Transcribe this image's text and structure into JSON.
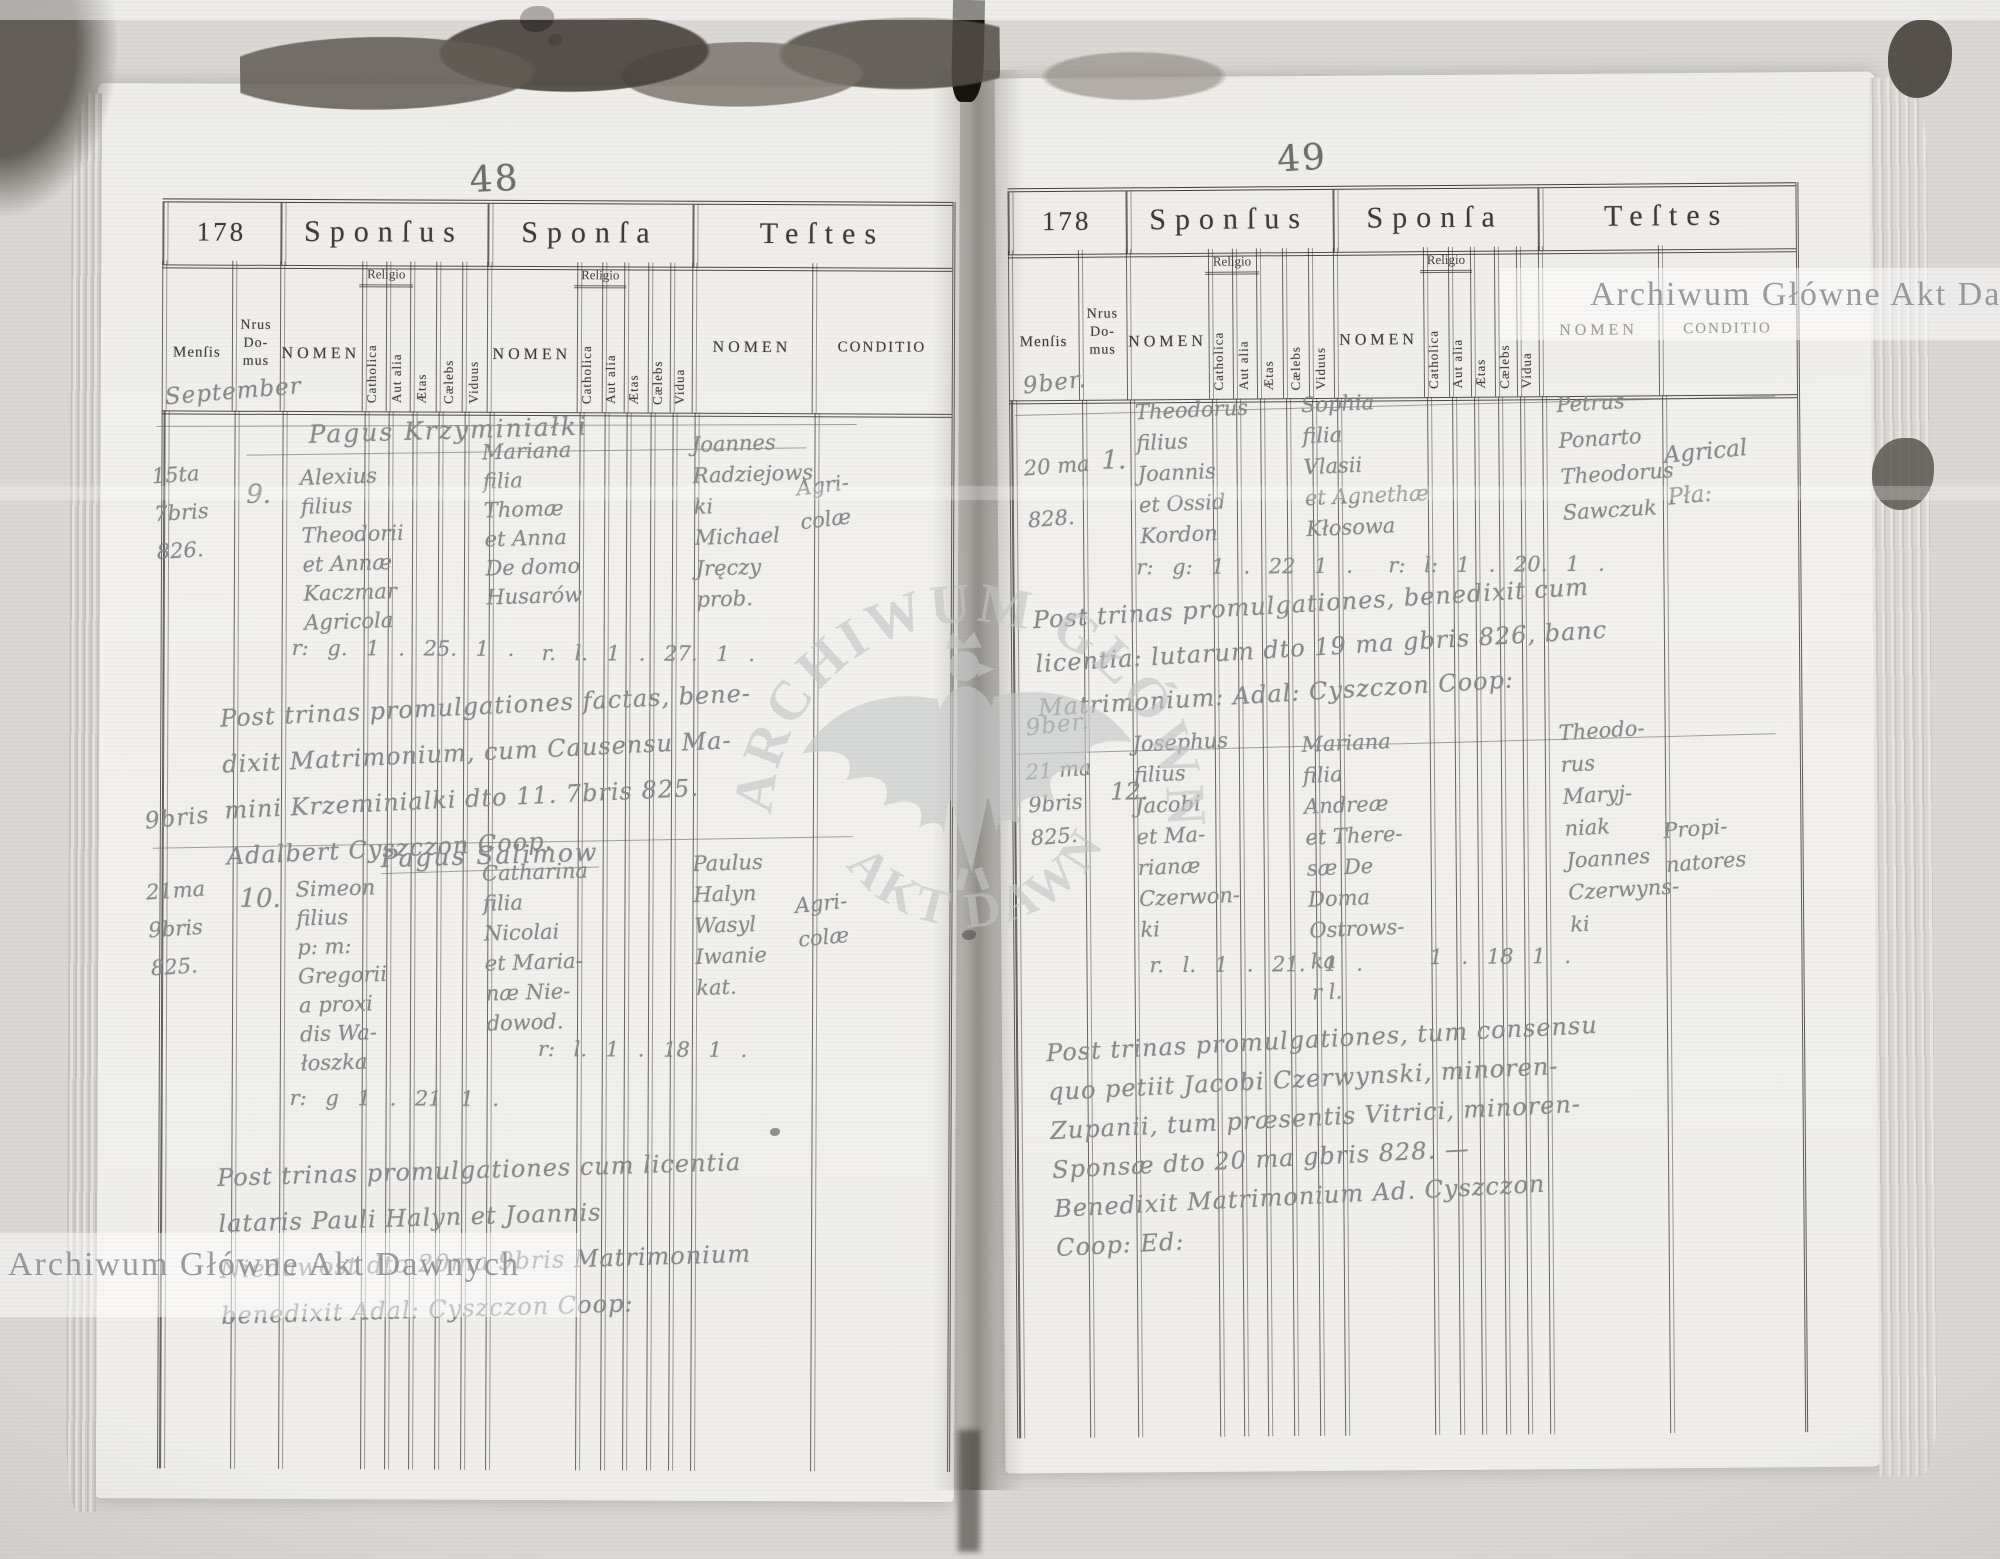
{
  "archive_stamp": "Archiwum Główne Akt Dawnych",
  "watermark": {
    "arc_top": "ARCHIWUM GŁÓWNE",
    "arc_bottom": "AKT DAWNYCH",
    "icon": "polish-eagle-watermark"
  },
  "form": {
    "form_no": "178",
    "sections": {
      "sponsus": "Sponſus",
      "sponsa": "Sponſa",
      "testes": "Teſtes"
    },
    "columns": {
      "mensis": "Menſis",
      "nrus_domus": [
        "Nrus",
        "Do-",
        "mus"
      ],
      "nomen": "NOMEN",
      "religio": "Religio",
      "catholica": "Catholica",
      "aut_alia": "Aut alia",
      "aetas": "Ætas",
      "caelebs": "Cælebs",
      "viduus": "Viduus",
      "vidua": "Vidua",
      "conditio": "CONDITIO"
    }
  },
  "pages": {
    "left": {
      "page_number": "48",
      "month_margin": "September",
      "entries": [
        {
          "date_lines": [
            "15ta",
            "7bris",
            "826."
          ],
          "house": "9.",
          "village": "Pagus Krzyminiałki",
          "groom_lines": [
            "Alexius",
            "filius",
            "Theodorii",
            "et Annæ",
            "Kaczmar",
            "Agricola"
          ],
          "groom_row": "r: g. 1 . 25. 1 .",
          "bride_lines": [
            "Mariana",
            "filia",
            "Thomæ",
            "et Anna",
            "De domo",
            "Husarów"
          ],
          "bride_row": "r. l. 1 . 27. 1 .",
          "witness_lines": [
            "Joannes",
            "Radziejows",
            "ki",
            "Michael",
            "Jręczy",
            "prob."
          ],
          "witness_condition": [
            "Agri-",
            "colæ"
          ],
          "note_lines": [
            "Post trinas promulgationes factas, bene-",
            "dixit Matrimonium, cum Causensu Ma-",
            "mini Krzeminialki dto 11. 7bris 825.",
            "Adalbert Cyszczon Coop."
          ]
        },
        {
          "margin": "9bris",
          "date_lines": [
            "21ma",
            "9bris",
            "825."
          ],
          "house": "10.",
          "village": "Pagus Salimow",
          "groom_lines": [
            "Simeon",
            "filius",
            "p: m:",
            "Gregorii",
            "a proxi",
            "dis Wa-",
            "łoszka"
          ],
          "groom_row": "r: g 1 . 21 1 .",
          "bride_lines": [
            "Catharina",
            "filia",
            "Nicolai",
            "et Maria-",
            "næ Nie-",
            "dowod."
          ],
          "bride_row": "r: l. 1 . 18 1 .",
          "witness_lines": [
            "Paulus",
            "Halyn",
            "Wasyl",
            "Iwanie",
            "kat."
          ],
          "witness_condition": [
            "Agri-",
            "colæ"
          ],
          "note_lines": [
            "Post trinas promulgationes cum licentia",
            "lataris Pauli Halyn et Joannis",
            "Niedawost dto 20ma 9bris Matrimonium",
            "benedixit Adal: Cyszczon Coop:"
          ]
        }
      ]
    },
    "right": {
      "page_number": "49",
      "entries": [
        {
          "margin": "9ber.",
          "date_lines": [
            "20 ma",
            "828."
          ],
          "house": "1.",
          "groom_lines": [
            "Theodorus",
            "filius",
            "Joannis",
            "et Ossid",
            "Kordon"
          ],
          "groom_row": "r: g: 1 . 22 1 .",
          "bride_lines": [
            "Sophia",
            "filia",
            "Vlasii",
            "et Agnethæ",
            "Kłosowa"
          ],
          "bride_row": "r: l: 1 . 20. 1 .",
          "witness_lines": [
            "Petrus",
            "Ponarto",
            "Theodorus",
            "Sawczuk"
          ],
          "witness_condition": [
            "Agrical",
            "Pła:"
          ],
          "note_lines": [
            "Post trinas promulgationes, benedixit cum",
            "licentia: lutarum dto 19 ma gbris 826, banc",
            "Matrimonium: Adal: Cyszczon Coop:"
          ]
        },
        {
          "margin": "9ber.",
          "date_lines": [
            "21 ma",
            "9bris",
            "825."
          ],
          "house": "12.",
          "groom_lines": [
            "Josephus",
            "filius",
            "Jacobi",
            "et Ma-",
            "rianæ",
            "Czerwon-",
            "ki"
          ],
          "groom_row": "r. l. 1 . 21. 1 .",
          "bride_lines": [
            "Mariana",
            "filia",
            "Andreæ",
            "et There-",
            "sæ De",
            "Doma",
            "Ostrows-",
            "ka",
            "r l."
          ],
          "bride_row": "1 . 18 1 .",
          "witness_lines": [
            "Theodo-",
            "rus",
            "Maryj-",
            "niak",
            "Joannes",
            "Czerwyns-",
            "ki"
          ],
          "witness_condition": [
            "Propi-",
            "natores"
          ],
          "note_lines": [
            "Post trinas promulgationes, tum consensu",
            "quo petiit Jacobi Czerwynski, minoren-",
            "Zupanii, tum præsentis Vitrici, minoren-",
            "Sponsæ dto 20 ma gbris 828. —",
            "Benedixit Matrimonium Ad. Cyszczon",
            "Coop: Ed:"
          ]
        }
      ]
    }
  }
}
